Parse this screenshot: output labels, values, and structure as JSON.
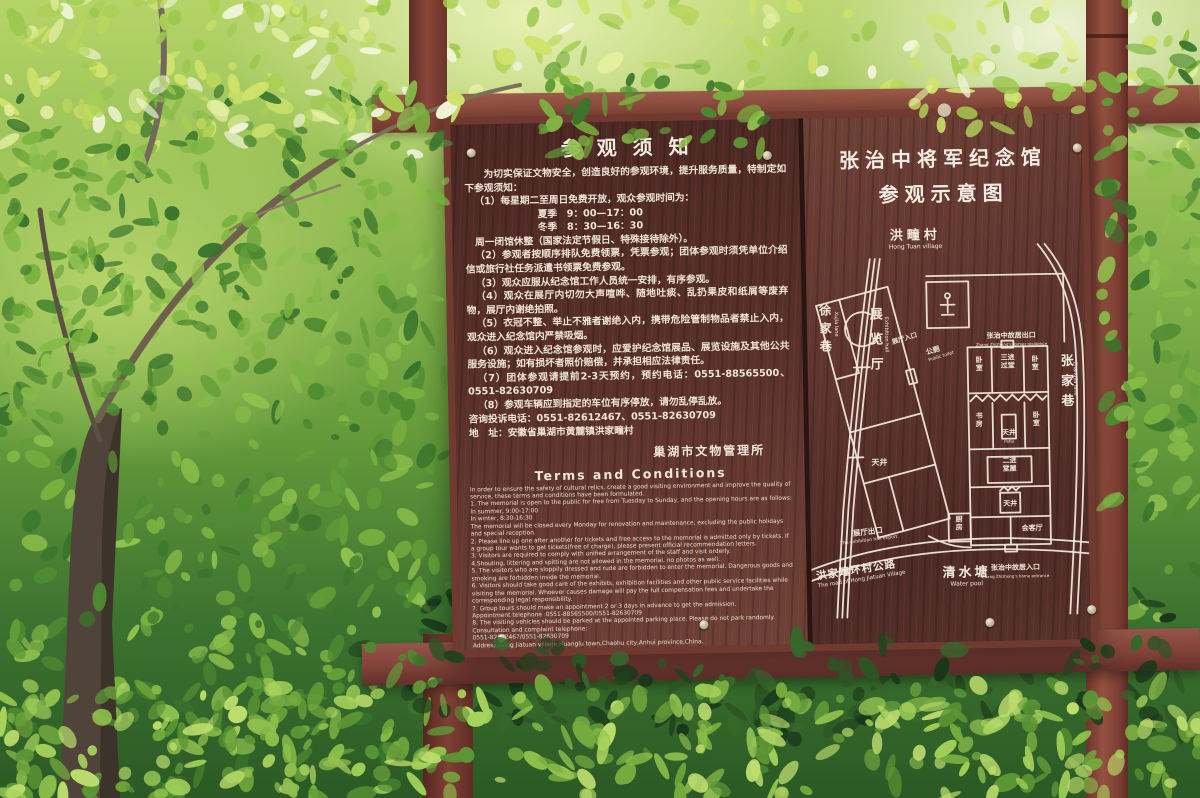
{
  "colors": {
    "board_panel": "#57302b",
    "frame_wood": "#8a4a3c",
    "sign_text": "#f2eadf",
    "map_lines": "#f0e7db",
    "foliage_light": "#cfe36c",
    "foliage_dark": "#2c5424"
  },
  "left_panel": {
    "title": "参观须知",
    "intro": "为切实保证文物安全，创造良好的参观环境，提升服务质量，特制定如下参观须知：",
    "rules": [
      "（1）每星期二至周日免费开放，观众参观时间为：",
      "夏季　9：00—17：00",
      "冬季　8：30—16：30",
      "周一闭馆休整（国家法定节假日、特殊接待除外）。",
      "（2）参观者按顺序排队免费领票，凭票参观；团体参观时须凭单位介绍信或旅行社任务派遣书领票免费参观。",
      "（3）观众应服从纪念馆工作人员统一安排，有序参观。",
      "（4）观众在展厅内切勿大声喧哗、随地吐痰、乱扔果皮和纸屑等废弃物，展厅内谢绝拍照。",
      "（5）衣冠不整、举止不雅者谢绝入内，携带危险管制物品者禁止入内，观众进入纪念馆内严禁吸烟。",
      "（6）观众进入纪念馆参观时，应爱护纪念馆展品、展览设施及其他公共服务设施；如有损坏者照价赔偿，并承担相应法律责任。",
      "（7）团体参观请提前2-3天预约，预约电话：0551-88565500、0551-82630709",
      "（8）参观车辆应到指定的车位有序停放，请勿乱停乱放。"
    ],
    "phone_line": "咨询投诉电话：0551-82612467、0551-82630709",
    "address_line": "地　址：安徽省巢湖市黄麓镇洪家疃村",
    "signature": "巢湖市文物管理所",
    "en_title": "Terms and Conditions",
    "en_lines": [
      "In order to ensure the safety of cultural relics, create a good visiting environment and improve the quality of service, these terms and conditions have been formulated.",
      "1. The memorial is open to the public for free from Tuesday to Sunday, and the opening hours are as follows:",
      "In summer, 9:00-17:00",
      "In winter, 8:30-16:30",
      "The memorial will be closed every Monday for renovation and maintenance, excluding the public holidays and special reception.",
      "2. Please line up one after another for tickets and free access to the memorial is admitted only by tickets. If a group tour wants to get tickets(free of charge), please present official recommendation letters.",
      "3. Visitors are required to comply with unified arrangement of the staff and visit orderly.",
      "4.Shouting, littering and spitting are not allowed in the memorial, no photos as well.",
      "5. The visitors who are sloppily dressed and rude are forbidden to enter the memorial. Dangerous goods and smoking are forbidden inside the memorial.",
      "6. Visitors should take good care of the exhibits, exhibition facilities and other public service facilities while visiting the memorial. Whoever causes damage will pay the full compensation fees and undertake the corresponding legal responsibility.",
      "7. Group tours should make an appointment 2 or 3 days in advance to get the admission.",
      "Appointment telephone :0551-88565500/0551-82630709",
      "8. The visiting vehicles should be parked at the appointed parking place. Please do not park randomly.",
      "Consultation and complaint telephone:",
      "0551-82612467/0551-82630709",
      "Address:Hong Jiatuan village,Huanglu town,Chaohu city,Anhui province,China.",
      "Chaohu City Management Station of Cultural relics"
    ]
  },
  "right_panel": {
    "title_line1": "张治中将军纪念馆",
    "title_line2": "参观示意图",
    "map": {
      "village": {
        "zh": "洪疃村",
        "en": "Hong Tuan village"
      },
      "xujia_lane": {
        "zh": "徐家巷",
        "en": "Xujia lane"
      },
      "zhangjia_lane": {
        "zh": "张家巷",
        "en": "Zhangjia lane"
      },
      "ring_road": {
        "zh": "洪家疃环村公路",
        "en": "The road of Hong Jiatuan Village"
      },
      "water_pool": {
        "zh": "清水塘",
        "en": "Water pool"
      },
      "exhibition_hall": {
        "zh": "展览厅",
        "en": "Exhibition hall"
      },
      "hall_entrance": {
        "zh": "展厅入口"
      },
      "hall_exit": {
        "zh": "展厅出口",
        "en": "The exhibition hall export"
      },
      "public_toilet": {
        "zh": "公厕",
        "en": "Public toilet"
      },
      "residence_exit": {
        "zh": "张治中故居出口",
        "en": "Zhang Zhizhong's former residence"
      },
      "residence_entrance": {
        "zh": "张治中故居入口",
        "en": "Zhang Zhizhong's home entrance"
      },
      "rooms": {
        "bedroom_a": "卧室",
        "hall_three": "三进过堂",
        "bedroom_b": "卧室",
        "study": "书房",
        "patio_a": "天井",
        "patio_en": "Patio",
        "bedroom_c": "卧室",
        "hall_two": "二进堂屋",
        "patio_b": "天井",
        "kitchen": "厨房",
        "reception": "会客厅",
        "patio_hall": "天井"
      }
    }
  }
}
